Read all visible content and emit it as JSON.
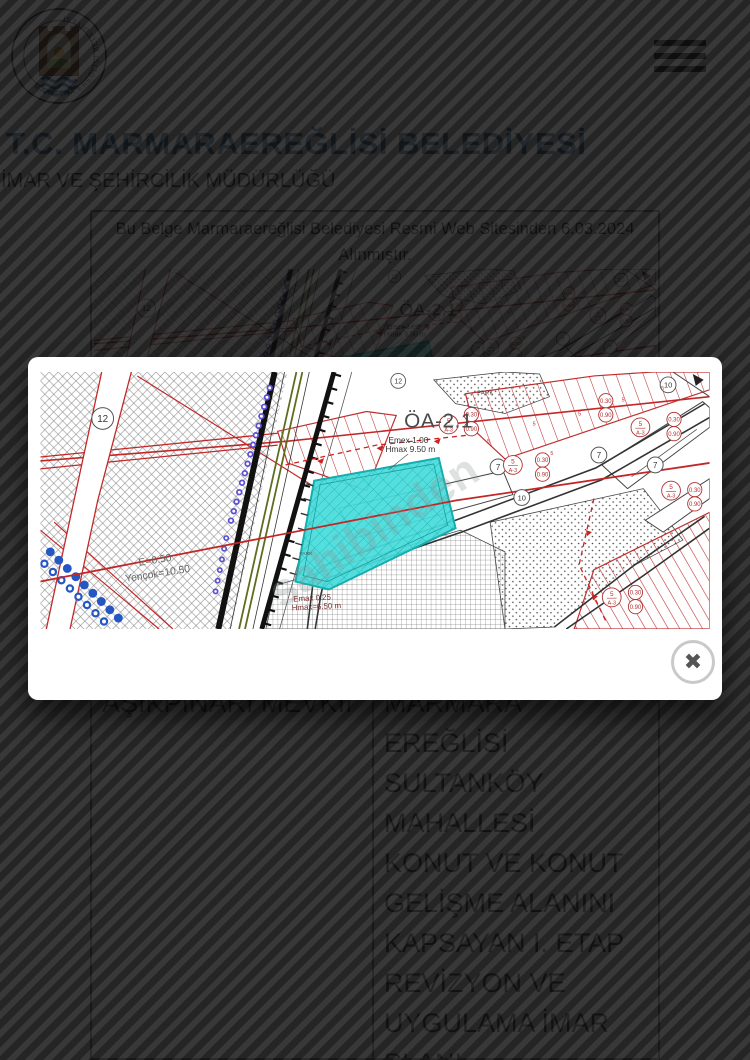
{
  "page": {
    "logo": {
      "ring_text": "MARMARA EREĞLİSİ BELEDİYESİ"
    },
    "title": "T.C. MARMARAEREĞLİSİ BELEDİYESİ",
    "subtitle": "İMAR VE ŞEHİRCİLİK MÜDÜRLÜĞÜ",
    "document": {
      "note_line1": "Bu Belge Marmaraereğlisi Belediyesi Resmi Web Sitesinden 6.03.2024",
      "note_line2": "Alınmıştır.",
      "table": {
        "left_cell": "AŞIKPINARI MEVKİİ",
        "right_cell_lines": [
          "MARMARA",
          "EREĞLİSİ",
          "SULTANKÖY",
          "MAHALLESİ",
          "KONUT VE KONUT",
          "GELİŞME ALANINI",
          "KAPSAYAN I. ETAP",
          "REVİZYON VE",
          "UYGULAMA İMAR",
          "PLANI"
        ]
      }
    }
  },
  "modal": {
    "close_icon": "✖"
  },
  "map": {
    "labels": {
      "zone": "ÖA-2.1",
      "emex": "Emex 1.00",
      "hmax": "Hmax 9.50 m",
      "e050": "E=0.50",
      "yencok": "Yençok=10.50",
      "emax025": "Emax 0.25",
      "hmax650": "Hmax=6.50 m",
      "park": "PARK",
      "watermark": "sahibinden",
      "c12": "12",
      "c10": "10",
      "c7": "7",
      "r_top": "0.30",
      "r_bottom": "0.90",
      "f_top": "5",
      "f_bottom": "A-3"
    },
    "colors": {
      "highlight": "#47DBDB",
      "parcel_red": "#C43030",
      "overlay_stripe": "#222222"
    }
  }
}
